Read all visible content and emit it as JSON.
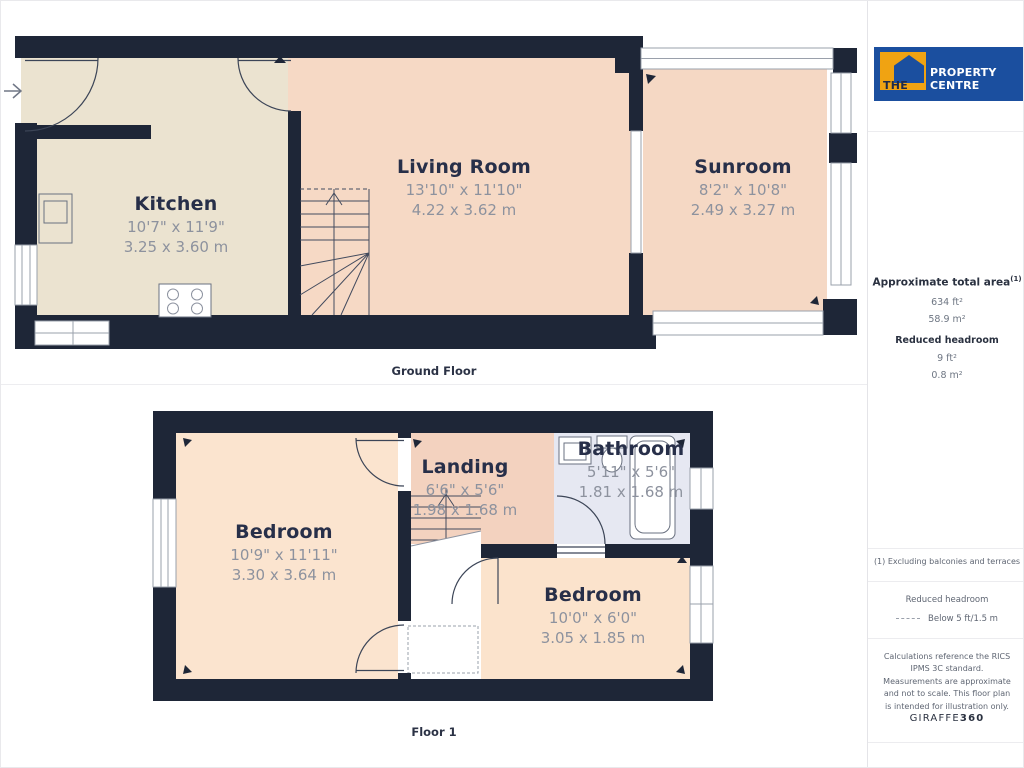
{
  "branding": {
    "logo_the": "THE",
    "logo_rest": "PROPERTY CENTRE",
    "colors": {
      "logo_blue": "#1b4f9f",
      "logo_orange": "#f0a312",
      "wall_navy": "#1e2637"
    }
  },
  "sidebar": {
    "total_area": {
      "heading": "Approximate total area",
      "footnote_mark": "(1)",
      "value_ft": "634 ft²",
      "value_m": "58.9 m²"
    },
    "reduced_headroom": {
      "heading": "Reduced headroom",
      "value_ft": "9 ft²",
      "value_m": "0.8 m²"
    },
    "footnote": "(1) Excluding balconies and terraces",
    "legend": {
      "heading": "Reduced headroom",
      "item": "Below 5 ft/1.5 m"
    },
    "disclaimer": "Calculations reference the RICS IPMS 3C standard. Measurements are approximate and not to scale. This floor plan is intended for illustration only.",
    "brand_giraffe": "GIRAFFE",
    "brand_360": "360"
  },
  "floors": [
    {
      "label": "Ground Floor",
      "rooms": [
        {
          "name": "Kitchen",
          "imperial": "10'7\" x 11'9\"",
          "metric": "3.25 x 3.60 m"
        },
        {
          "name": "Living Room",
          "imperial": "13'10\" x 11'10\"",
          "metric": "4.22 x 3.62 m"
        },
        {
          "name": "Sunroom",
          "imperial": "8'2\" x 10'8\"",
          "metric": "2.49 x 3.27 m"
        }
      ]
    },
    {
      "label": "Floor 1",
      "rooms": [
        {
          "name": "Bedroom",
          "imperial": "10'9\" x 11'11\"",
          "metric": "3.30 x 3.64 m"
        },
        {
          "name": "Landing",
          "imperial": "6'6\" x 5'6\"",
          "metric": "1.98 x 1.68 m"
        },
        {
          "name": "Bathroom",
          "imperial": "5'11\" x 5'6\"",
          "metric": "1.81 x 1.68 m"
        },
        {
          "name": "Bedroom",
          "imperial": "10'0\" x 6'0\"",
          "metric": "3.05 x 1.85 m"
        }
      ]
    }
  ]
}
